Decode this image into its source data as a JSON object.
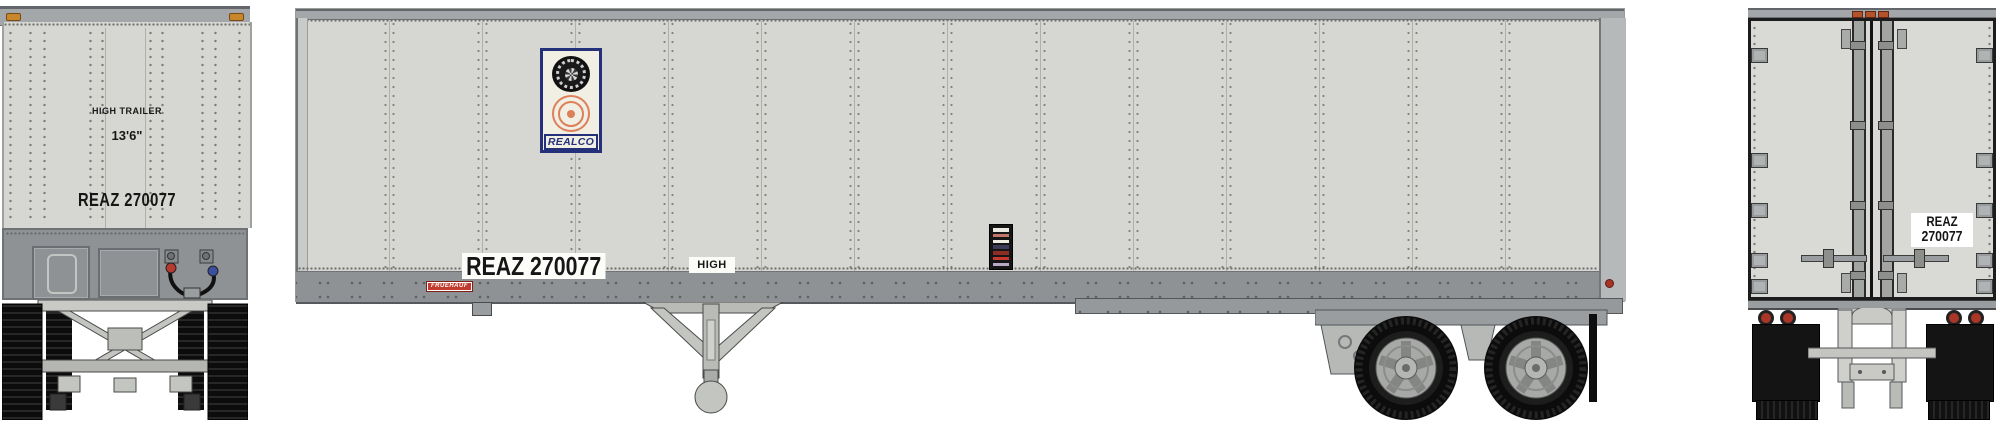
{
  "front_view": {
    "high_trailer_label": "HIGH TRAILER",
    "height_label": "13'6\"",
    "reporting_mark": "REAZ 270077"
  },
  "side_view": {
    "realco_logo_text": "REALCO",
    "reporting_mark": "REAZ 270077",
    "fruehauf_badge_text": "FRUEHAUF",
    "high_label": "HIGH"
  },
  "rear_view": {
    "reporting_mark_line1": "REAZ",
    "reporting_mark_line2": "270077"
  },
  "colors": {
    "body_gray": "#d6d6d2",
    "panel_line": "#b0b0ab",
    "skirt_gray": "#8f9295",
    "rail_gray": "#a4a7aa",
    "dark_edge": "#63666a",
    "rim_gray": "#a7a9a6",
    "realco_blue": "#24307a",
    "realco_cream": "#f1eee4",
    "realco_orange": "#dd7f58",
    "fruehauf_red": "#c23b2c",
    "marker_amber": "#c8872c",
    "clearance_orange": "#b4532a",
    "tail_light_red": "#a93627",
    "hose_red": "#b8392e",
    "hose_blue": "#3a4fa0",
    "mark_text": "#161616",
    "label_bg": "#ffffff"
  }
}
